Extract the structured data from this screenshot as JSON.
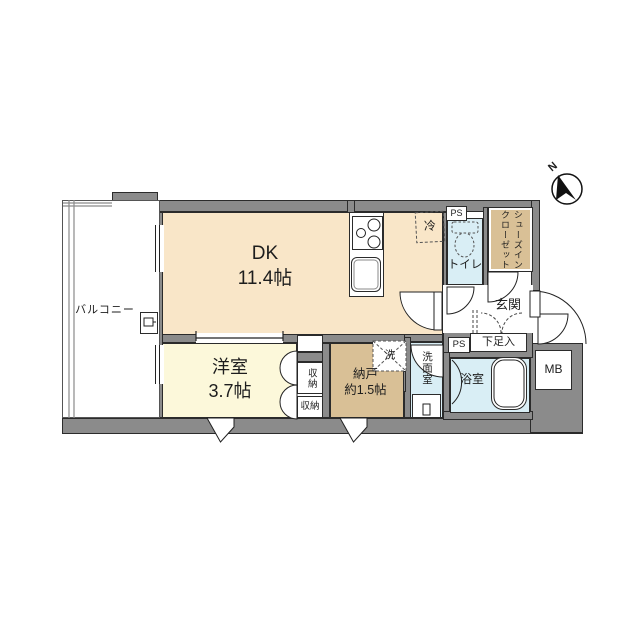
{
  "compass": {
    "label": "N"
  },
  "balcony": {
    "label": "バルコニー"
  },
  "dk": {
    "name_line": "DK",
    "size_line": "11.4帖"
  },
  "western_room": {
    "name_line": "洋室",
    "size_line": "3.7帖"
  },
  "storeroom": {
    "name_line": "納戸",
    "size_line": "約1.5帖"
  },
  "closet_upper": {
    "label": "収納"
  },
  "closet_lower": {
    "label": "収納"
  },
  "refrigerator": {
    "label": "冷"
  },
  "toilet": {
    "label": "トイレ"
  },
  "shoes_in_closet": {
    "line1": "シューズイン",
    "line2": "クローゼット"
  },
  "entrance": {
    "label": "玄関"
  },
  "shoe_cabinet": {
    "label": "下足入"
  },
  "pipe_space_top": {
    "label": "PS"
  },
  "pipe_space_bottom": {
    "label": "PS"
  },
  "washer": {
    "label": "洗"
  },
  "washroom": {
    "label": "洗面室"
  },
  "bathroom": {
    "label": "浴室"
  },
  "meter_box": {
    "label": "MB"
  },
  "colors": {
    "wall": "#8b8b8b",
    "dk_floor": "#f9e6c8",
    "western_floor": "#fcf8da",
    "tan_floor": "#d9c096",
    "wet_floor": "#d9eef5"
  }
}
